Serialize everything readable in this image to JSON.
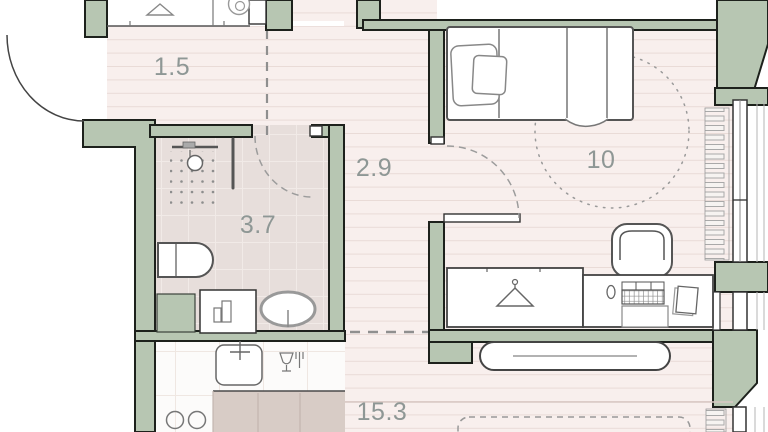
{
  "plan": {
    "title": "apartment-floor-plan",
    "rooms": [
      {
        "id": "hallway",
        "label": "1.5",
        "features": [
          "wardrobe",
          "hanger-icon",
          "washing-machine-icon",
          "entrance-door-arc"
        ]
      },
      {
        "id": "bathroom",
        "label": "3.7",
        "features": [
          "shower-head",
          "shower-tray-dots",
          "glass-partition",
          "toilet",
          "vanity-counter",
          "toiletries",
          "oval-washbasin",
          "duct-shaft"
        ]
      },
      {
        "id": "corridor",
        "label": "2.9",
        "features": [
          "door-arc-to-bedroom",
          "dashed-zone-line"
        ]
      },
      {
        "id": "bedroom",
        "label": "10",
        "features": [
          "single-bed",
          "pillows",
          "blanket",
          "clearance-circle",
          "desk-chair",
          "wardrobe-with-hanger",
          "desk",
          "keyboard",
          "mouse",
          "book",
          "window",
          "radiator"
        ]
      },
      {
        "id": "living-kitchen",
        "label": "15.3",
        "features": [
          "kitchen-sink",
          "faucet",
          "dishwasher-icon",
          "hob-burners",
          "worktop",
          "sideboard",
          "dashed-sofa",
          "window",
          "radiator"
        ]
      }
    ],
    "colors": {
      "wall": "#b7c6b2",
      "wall_outline": "#1d211c",
      "floor_stripe_base": "#f8efed",
      "floor_stripe_line": "#e9dbd7",
      "bathroom_floor": "#e7dedb",
      "kitchen_counter": "#d8ccc6",
      "furniture_outline": "#555555",
      "label": "#8e9795"
    }
  }
}
